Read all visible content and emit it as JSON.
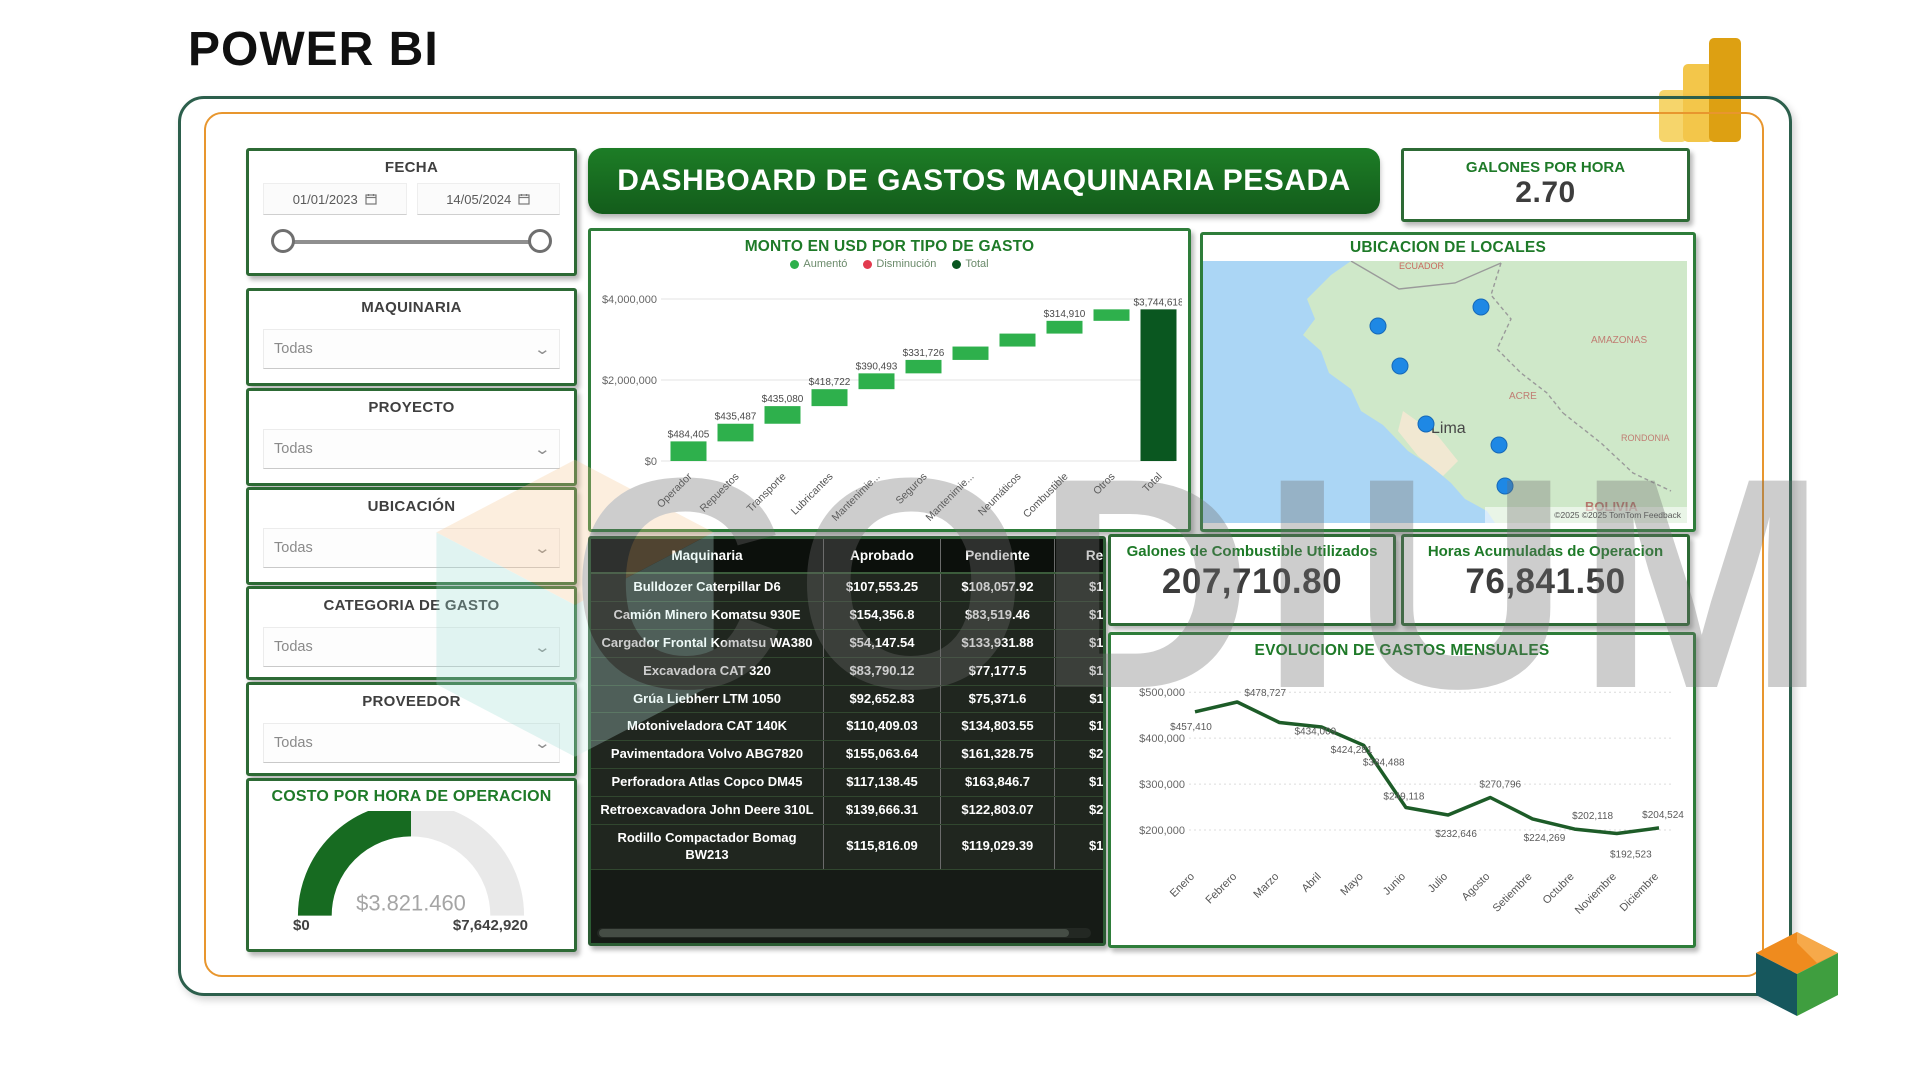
{
  "page": {
    "heading": "POWER BI",
    "watermark": "CODIUM"
  },
  "header": {
    "title": "DASHBOARD DE GASTOS MAQUINARIA PESADA"
  },
  "colors": {
    "accent_green": "#1e7a28",
    "banner_green": "#176b21",
    "increase": "#2eb04c",
    "decrease": "#e23a4e",
    "total": "#0a5720",
    "marker_blue": "#1e88e5",
    "frame_orange": "#e8962e"
  },
  "filters": {
    "fecha": {
      "label": "FECHA",
      "start_date": "01/01/2023",
      "end_date": "14/05/2024"
    },
    "dropdowns": [
      {
        "label": "MAQUINARIA",
        "value": "Todas"
      },
      {
        "label": "PROYECTO",
        "value": "Todas"
      },
      {
        "label": "UBICACIÓN",
        "value": "Todas"
      },
      {
        "label": "CATEGORIA DE GASTO",
        "value": "Todas"
      },
      {
        "label": "PROVEEDOR",
        "value": "Todas"
      }
    ]
  },
  "gauge": {
    "title": "COSTO POR HORA DE OPERACION",
    "value": "$3.821.460",
    "min": "$0",
    "max": "$7,642,920",
    "fraction": 0.5
  },
  "kpis": {
    "galones_por_hora": {
      "title": "GALONES POR HORA",
      "value": "2.70"
    },
    "galones_combustible": {
      "title": "Galones de Combustible Utilizados",
      "value": "207,710.80"
    },
    "horas_operacion": {
      "title": "Horas Acumuladas de Operacion",
      "value": "76,841.50"
    }
  },
  "map": {
    "title": "UBICACION DE LOCALES",
    "city_label": "Lima",
    "region_labels": [
      "ECUADOR",
      "AMAZONAS",
      "ACRE",
      "RONDONIA",
      "BOLIVIA"
    ],
    "attribution": "©2025  ©2025 TomTom  Feedback",
    "markers": [
      [
        278,
        46
      ],
      [
        175,
        65
      ],
      [
        197,
        105
      ],
      [
        223,
        163
      ],
      [
        296,
        184
      ],
      [
        302,
        225
      ]
    ]
  },
  "chart_data": [
    {
      "type": "bar",
      "subtype": "waterfall",
      "title": "MONTO EN USD POR TIPO DE GASTO",
      "legend": [
        {
          "label": "Aumentó",
          "color": "#2eb04c"
        },
        {
          "label": "Disminución",
          "color": "#e23a4e"
        },
        {
          "label": "Total",
          "color": "#0a5720"
        }
      ],
      "categories": [
        "Operador",
        "Repuestos",
        "Transporte",
        "Lubricantes",
        "Mantenimie...",
        "Seguros",
        "Mantenimie...",
        "Neumáticos",
        "Combustible",
        "Otros",
        "Total"
      ],
      "values": [
        484405,
        435487,
        435080,
        418722,
        390493,
        331726,
        330000,
        320000,
        314910,
        283795
      ],
      "total": 3744618,
      "bar_labels": [
        "$484,405",
        "$435,487",
        "$435,080",
        "$418,722",
        "$390,493",
        "$331,726",
        "",
        "",
        "$314,910",
        "",
        "$3,744,618"
      ],
      "y_ticks": [
        0,
        2000000,
        4000000
      ],
      "y_tick_labels": [
        "$0",
        "$2,000,000",
        "$4,000,000"
      ],
      "ylim": [
        0,
        4000000
      ]
    },
    {
      "type": "line",
      "title": "EVOLUCION DE GASTOS MENSUALES",
      "categories": [
        "Enero",
        "Febrero",
        "Marzo",
        "Abril",
        "Mayo",
        "Junio",
        "Julio",
        "Agosto",
        "Setiembre",
        "Octubre",
        "Noviembre",
        "Diciembre"
      ],
      "values": [
        457410,
        478727,
        434009,
        424281,
        384488,
        249118,
        232646,
        270796,
        224269,
        202118,
        192523,
        204524
      ],
      "point_labels": [
        "$457,410",
        "$478,727",
        "$434,009",
        "$424,281",
        "$384,488",
        "$249,118",
        "$232,646",
        "$270,796",
        "$224,269",
        "$202,118",
        "$192,523",
        "$204,524"
      ],
      "y_ticks": [
        200000,
        300000,
        400000,
        500000
      ],
      "y_tick_labels": [
        "$200,000",
        "$300,000",
        "$400,000",
        "$500,000"
      ],
      "ylim": [
        150000,
        520000
      ],
      "line_color": "#1d5c28"
    },
    {
      "type": "table",
      "columns": [
        "Maquinaria",
        "Aprobado",
        "Pendiente",
        "Rechazado"
      ],
      "rows": [
        [
          "Bulldozer Caterpillar D6",
          "$107,553.25",
          "$108,057.92",
          "$128,408.6"
        ],
        [
          "Camión Minero Komatsu 930E",
          "$154,356.8",
          "$83,519.46",
          "$106,472.6"
        ],
        [
          "Cargador Frontal Komatsu WA380",
          "$54,147.54",
          "$133,931.88",
          "$105,660.9"
        ],
        [
          "Excavadora CAT 320",
          "$83,790.12",
          "$77,177.5",
          "$128,293.6"
        ],
        [
          "Grúa Liebherr LTM 1050",
          "$92,652.83",
          "$75,371.6",
          "$115,637.2"
        ],
        [
          "Motoniveladora CAT 140K",
          "$110,409.03",
          "$134,803.55",
          "$132,062.4"
        ],
        [
          "Pavimentadora Volvo ABG7820",
          "$155,063.64",
          "$161,328.75",
          "$215,140.1"
        ],
        [
          "Perforadora Atlas Copco DM45",
          "$117,138.45",
          "$163,846.7",
          "$160,079.4"
        ],
        [
          "Retroexcavadora John Deere 310L",
          "$139,666.31",
          "$122,803.07",
          "$208,639.3"
        ],
        [
          "Rodillo Compactador Bomag BW213",
          "$115,816.09",
          "$119,029.39",
          "$133,759.5"
        ]
      ]
    }
  ]
}
